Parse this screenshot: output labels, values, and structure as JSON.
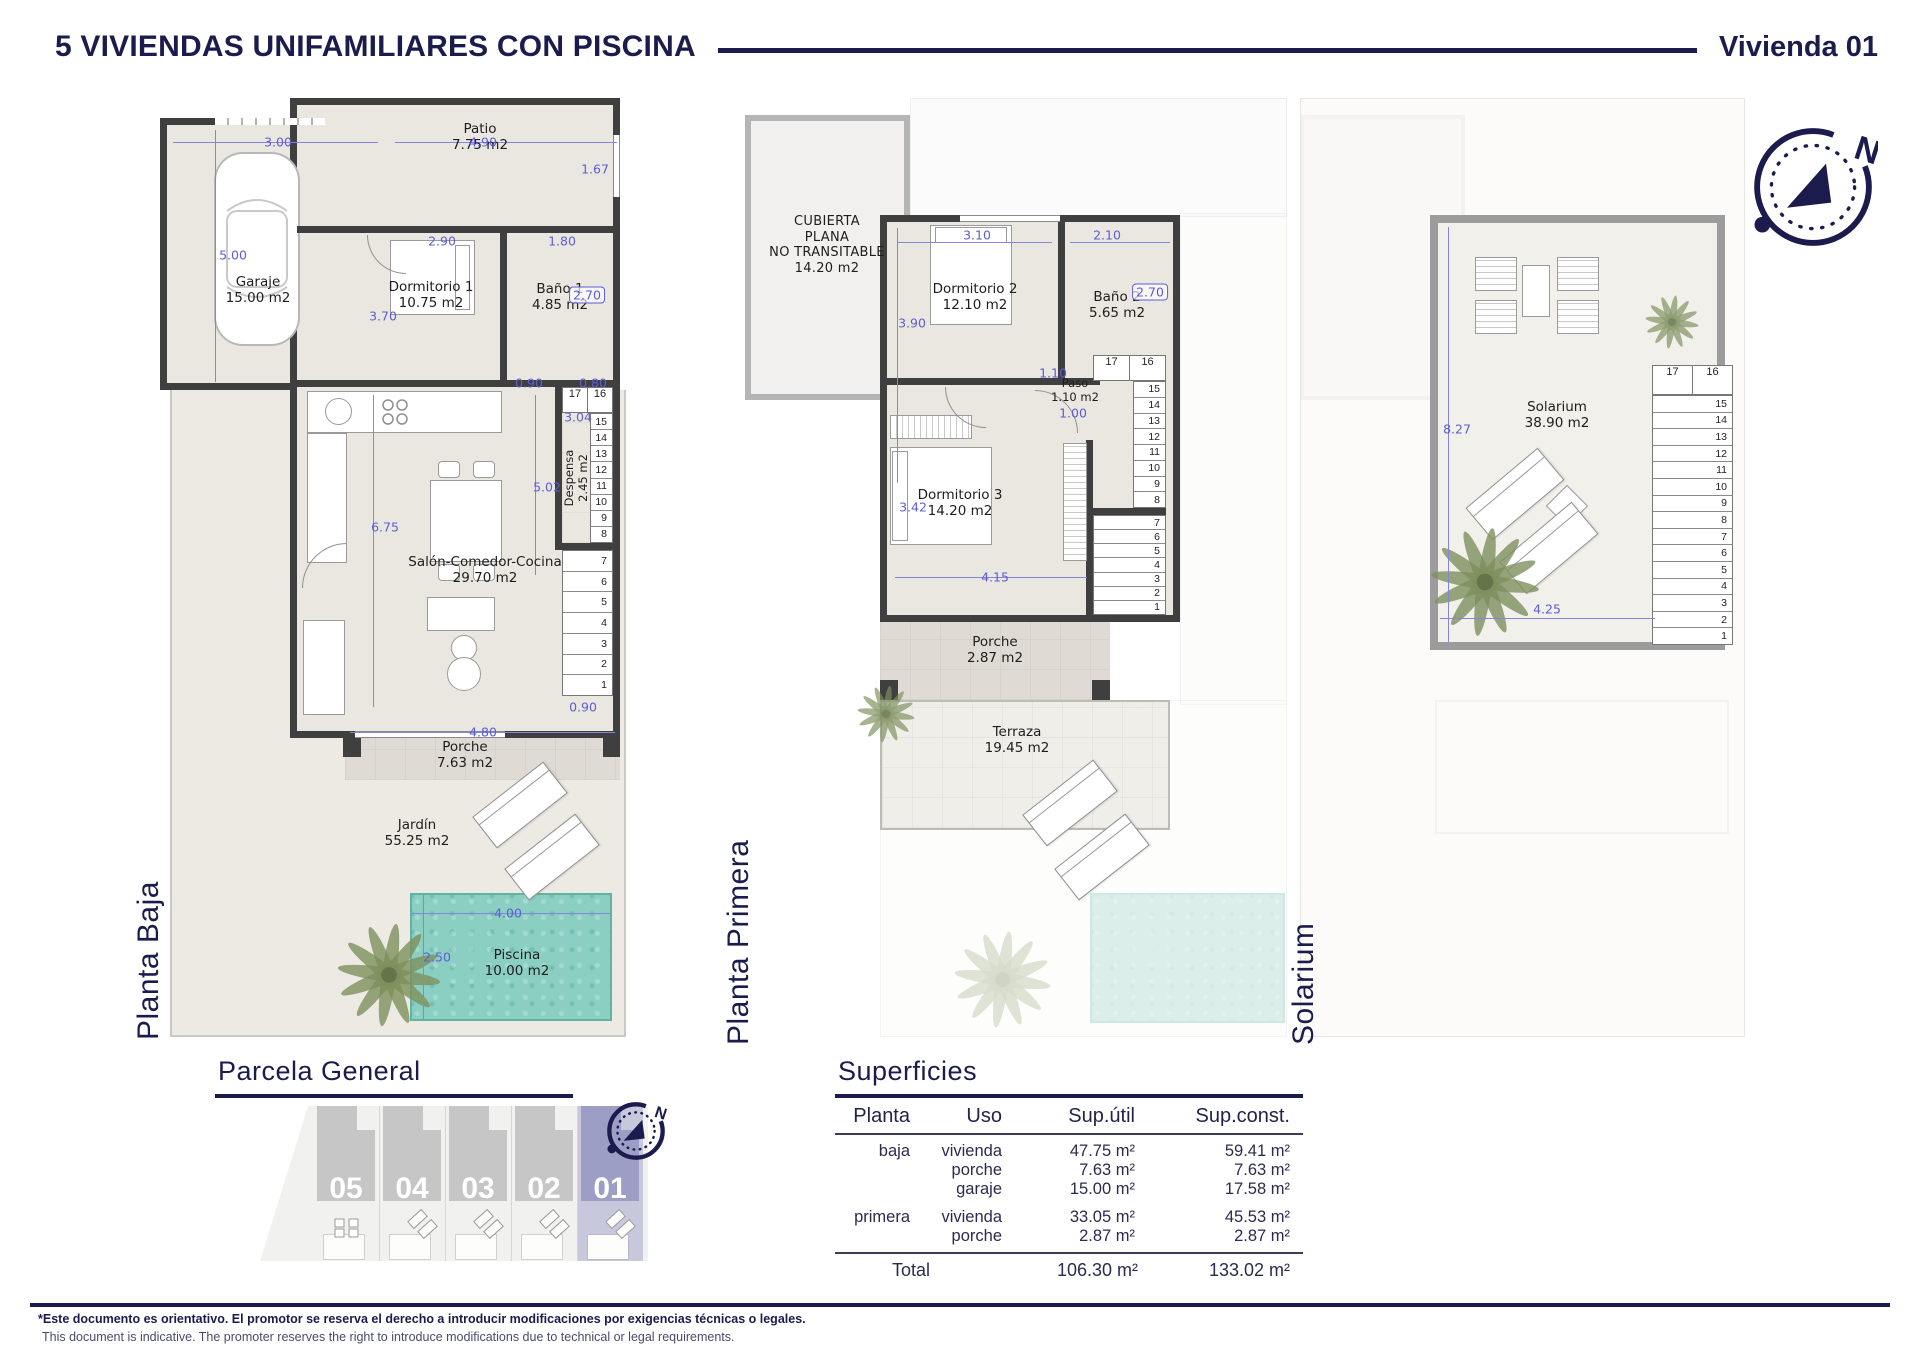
{
  "header": {
    "title": "5 VIVIENDAS UNIFAMILIARES CON PISCINA",
    "unit": "Vivienda 01"
  },
  "compass": {
    "north": "N"
  },
  "baja": {
    "floor_label": "Planta Baja",
    "rooms": {
      "garaje": {
        "name": "Garaje",
        "area": "15.00 m2"
      },
      "patio": {
        "name": "Patio",
        "area": "7.75 m2"
      },
      "dormitorio1": {
        "name": "Dormitorio 1",
        "area": "10.75 m2"
      },
      "bano1": {
        "name": "Baño 1",
        "area": "4.85 m2"
      },
      "despensa": {
        "name": "Despensa",
        "area": "2.45 m2"
      },
      "salon": {
        "name": "Salón-Comedor-Cocina",
        "area": "29.70 m2"
      },
      "porche": {
        "name": "Porche",
        "area": "7.63 m2"
      },
      "jardin": {
        "name": "Jardín",
        "area": "55.25 m2"
      },
      "piscina": {
        "name": "Piscina",
        "area": "10.00 m2"
      }
    },
    "dims": {
      "garaje_ancho": "3.00",
      "patio_ancho": "4.90",
      "patio_alto": "1.67",
      "garaje_alto": "5.00",
      "dorm1_ancho": "2.90",
      "bano1_ancho": "1.80",
      "bano1_alto": "2.70",
      "dorm1_alto": "3.70",
      "paso_escalera": "0.90",
      "escalera_ancho": "0.80",
      "despensa_alto": "3.04",
      "salon_alto": "5.02",
      "salon_lado": "6.75",
      "escalera_bajo": "0.90",
      "salon_ancho": "4.80",
      "piscina_ancho": "4.00",
      "piscina_alto": "2.50"
    },
    "stair_top": [
      "17",
      "16"
    ],
    "stairs_upper": [
      "15",
      "14",
      "13",
      "12",
      "11",
      "10",
      "9",
      "8"
    ],
    "stairs_lower": [
      "7",
      "6",
      "5",
      "4",
      "3",
      "2",
      "1"
    ]
  },
  "primera": {
    "floor_label": "Planta Primera",
    "rooms": {
      "cubierta": {
        "l1": "CUBIERTA",
        "l2": "PLANA",
        "l3": "NO TRANSITABLE",
        "area": "14.20 m2"
      },
      "dormitorio2": {
        "name": "Dormitorio 2",
        "area": "12.10 m2"
      },
      "bano2": {
        "name": "Baño 2",
        "area": "5.65 m2"
      },
      "paso": {
        "name": "Paso",
        "area": "1.10 m2"
      },
      "dormitorio3": {
        "name": "Dormitorio 3",
        "area": "14.20 m2"
      },
      "porche": {
        "name": "Porche",
        "area": "2.87 m2"
      },
      "terraza": {
        "name": "Terraza",
        "area": "19.45 m2"
      }
    },
    "dims": {
      "dorm2_ancho": "3.10",
      "bano2_ancho": "2.10",
      "dorm2_alto": "3.90",
      "bano2_alto": "2.70",
      "paso_ancho": "1.10",
      "paso_hueco": "1.00",
      "dorm3_alto": "3.42",
      "dorm3_ancho": "4.15"
    },
    "stair_top": [
      "17",
      "16"
    ],
    "stairs_upper": [
      "15",
      "14",
      "13",
      "12",
      "11",
      "10",
      "9",
      "8"
    ],
    "stairs_lower": [
      "7",
      "6",
      "5",
      "4",
      "3",
      "2",
      "1"
    ]
  },
  "solarium": {
    "floor_label": "Solarium",
    "rooms": {
      "solarium": {
        "name": "Solarium",
        "area": "38.90 m2"
      }
    },
    "dims": {
      "alto": "8.27",
      "ancho": "4.25"
    },
    "stair_top": [
      "17",
      "16"
    ],
    "stairs": [
      "15",
      "14",
      "13",
      "12",
      "11",
      "10",
      "9",
      "8",
      "7",
      "6",
      "5",
      "4",
      "3",
      "2",
      "1"
    ]
  },
  "parcela": {
    "title": "Parcela General",
    "units": [
      "05",
      "04",
      "03",
      "02",
      "01"
    ],
    "highlighted_unit": "01"
  },
  "superficies": {
    "title": "Superficies",
    "columns": {
      "planta": "Planta",
      "uso": "Uso",
      "util": "Sup.útil",
      "const": "Sup.const."
    },
    "baja": {
      "planta": "baja",
      "usos": [
        "vivienda",
        "porche",
        "garaje"
      ],
      "utiles": [
        "47.75 m²",
        "7.63 m²",
        "15.00 m²"
      ],
      "consts": [
        "59.41 m²",
        "7.63 m²",
        "17.58 m²"
      ]
    },
    "primera": {
      "planta": "primera",
      "usos": [
        "vivienda",
        "porche"
      ],
      "utiles": [
        "33.05 m²",
        "2.87 m²"
      ],
      "consts": [
        "45.53 m²",
        "2.87 m²"
      ]
    },
    "total": {
      "label": "Total",
      "util": "106.30 m²",
      "const": "133.02 m²"
    }
  },
  "footer": {
    "es": "*Este documento es orientativo. El promotor se reserva el derecho a introducir modificaciones por exigencias técnicas o legales.",
    "en": "This document is indicative. The promoter reserves the right to introduce modifications due to technical or legal requirements."
  },
  "colors": {
    "navy": "#1b1b4d",
    "dim_blue": "#5d5dd5",
    "pool": "#8bcfc3",
    "highlight": "#9d9ec6"
  }
}
